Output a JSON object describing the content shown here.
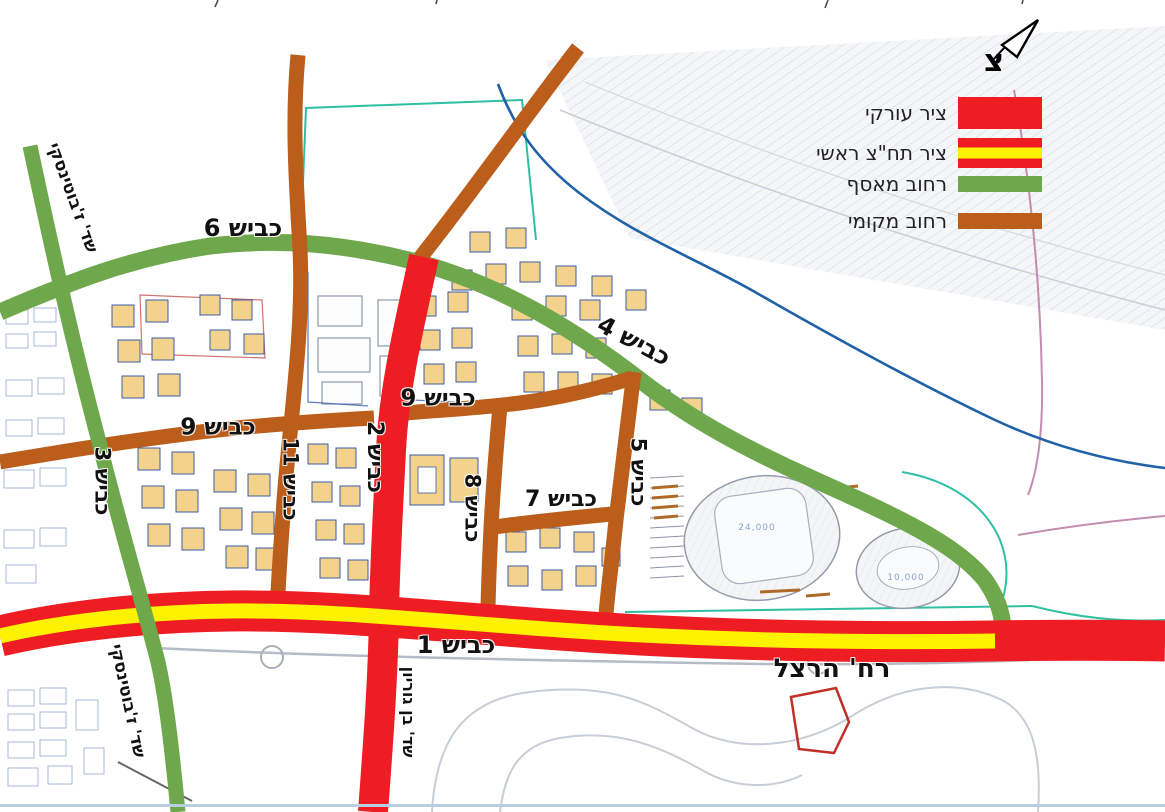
{
  "legend": {
    "items": [
      {
        "label": "ציר עורקי",
        "key": "arterial"
      },
      {
        "label": "ציר תח\"צ ראשי",
        "key": "transit"
      },
      {
        "label": "רחוב מאסף",
        "key": "collector"
      },
      {
        "label": "רחוב מקומי",
        "key": "local"
      }
    ]
  },
  "compass": {
    "letter": "צ"
  },
  "road_labels": {
    "kvish1": "כביש 1",
    "kvish2": "כביש 2",
    "kvish3": "כביש 3",
    "kvish4": "כביש 4",
    "kvish5": "כביש 5",
    "kvish6": "כביש 6",
    "kvish7": "כביש 7",
    "kvish8": "כביש 8",
    "kvish9_west": "כביש 9",
    "kvish9_east": "כביש 9",
    "kvish11": "כביש 11"
  },
  "street_labels": {
    "jabotinsky_north": "שד' ז'בוטינסקי",
    "jabotinsky_south": "שד' ז'בוטינסקי",
    "ben_gurion": "שד' בן גוריון",
    "herzl": "רח' הרצל"
  },
  "map_annotations": {
    "stadium_capacity": "24,000",
    "arena_capacity": "10,000"
  },
  "colors": {
    "arterial": "#EE1C23",
    "transit_stripe": "#FFF200",
    "collector": "#6FA84C",
    "local": "#BC5E1B",
    "river": "#2061A8",
    "teal": "#2FC0A1",
    "building_fill": "#F3D38B",
    "building_stroke": "#3C5CA6"
  }
}
